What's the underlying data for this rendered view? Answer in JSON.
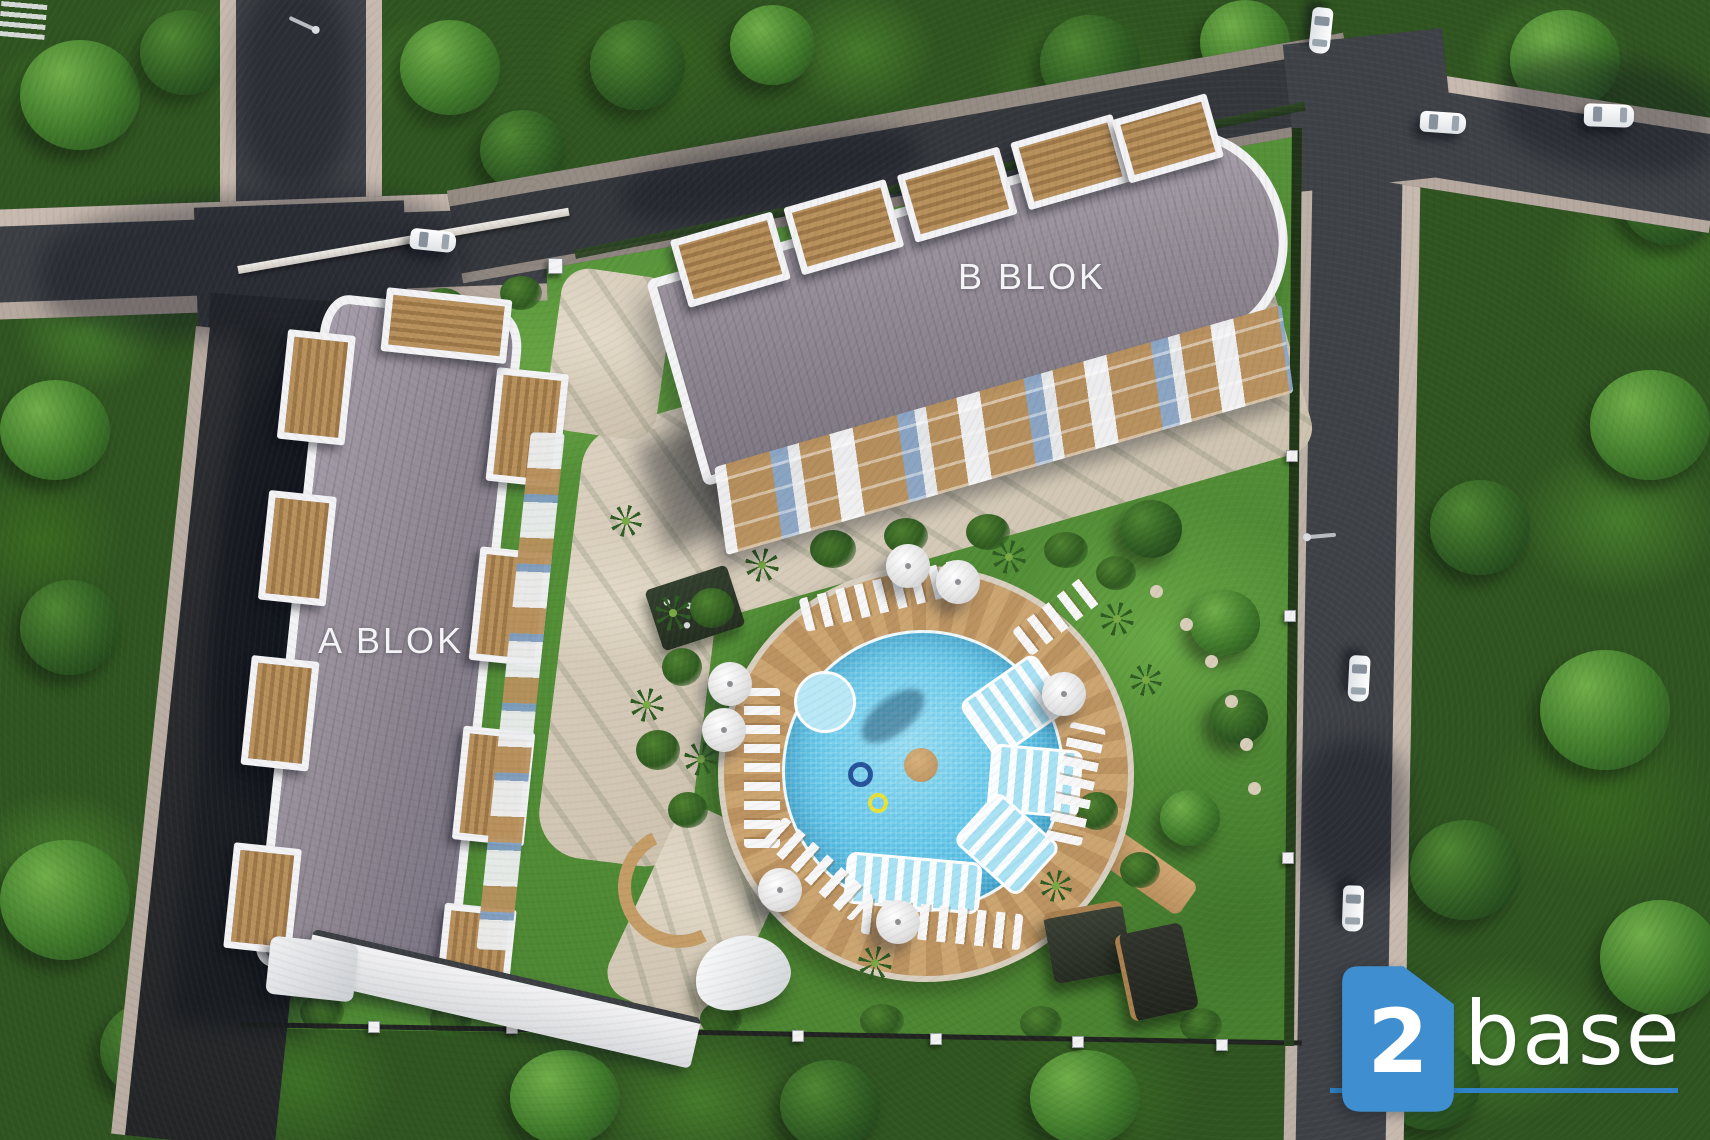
{
  "site": {
    "block_a_label": "A BLOK",
    "block_b_label": "B BLOK"
  },
  "logo": {
    "number": "2",
    "name": "base"
  },
  "colors": {
    "logo-blue": "#3e8ed0",
    "logo-line": "#2f82c5",
    "roof": "#938b95",
    "parapet": "#f3f3f5",
    "balcony-wood": "#b8905c",
    "facade-accent": "#7f9ec2",
    "pool-water": "#5ec4e8",
    "pool-shallow": "#a9e2f4",
    "pool-deck": "#c79e6b",
    "asphalt": "#3e4146",
    "sidewalk": "#c7b9ae",
    "lawn": "#579138",
    "forest": "#33591f"
  }
}
